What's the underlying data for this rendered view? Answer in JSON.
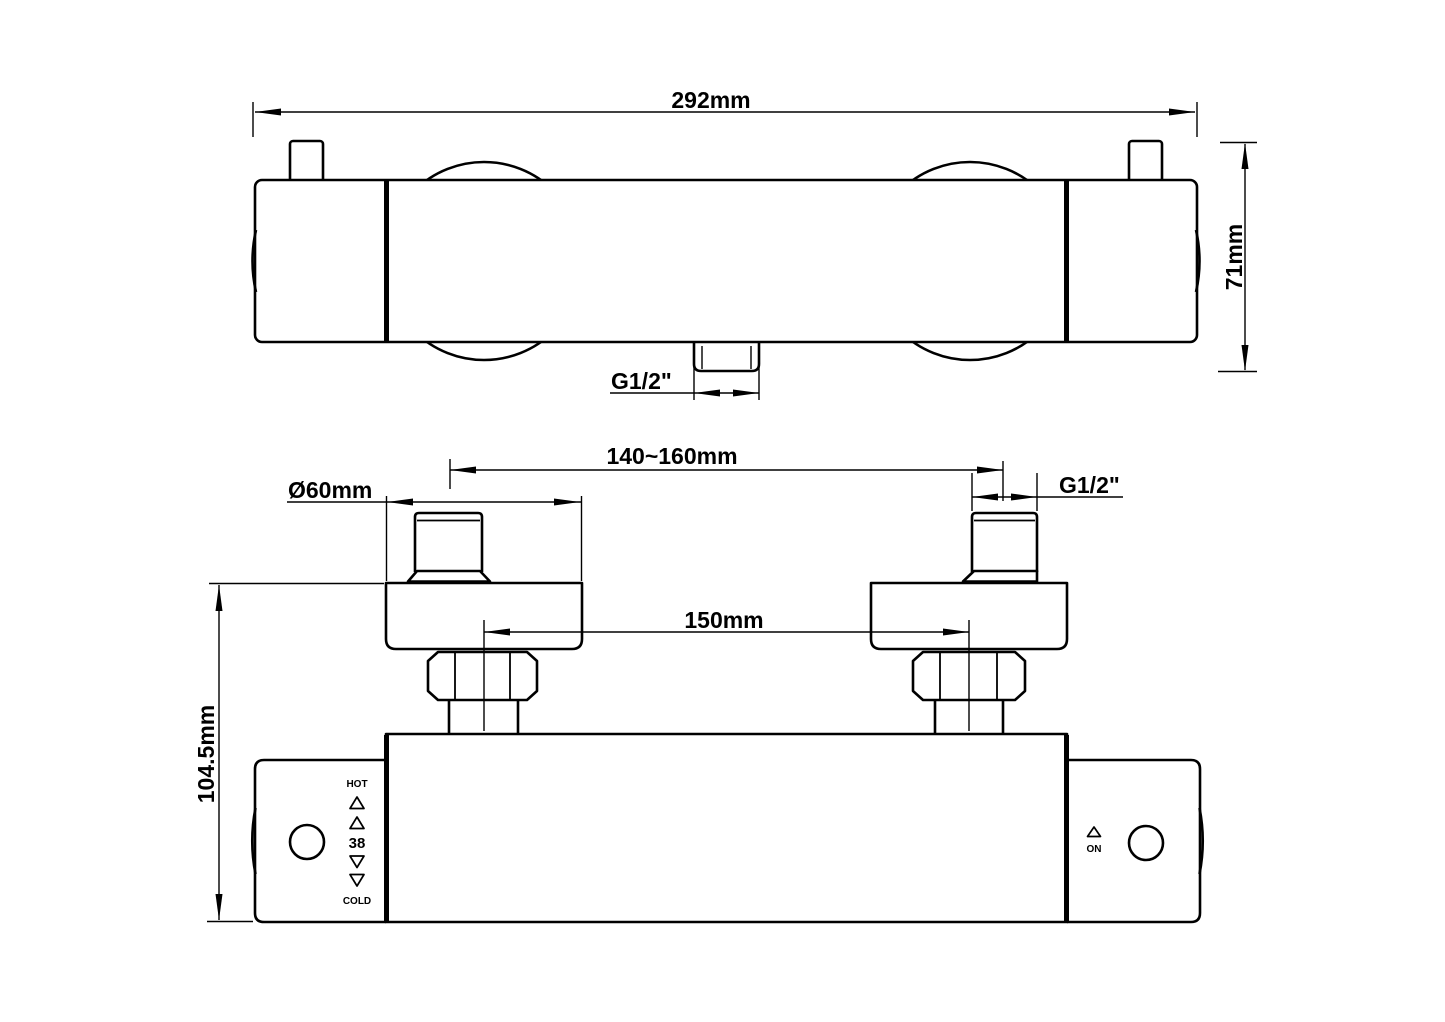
{
  "drawing": {
    "title": "thermostatic-shower-mixer-dimension-drawing",
    "background": "#ffffff",
    "line_color": "#000000",
    "top_view": {
      "width_label": "292mm",
      "height_label": "71mm",
      "outlet_thread_label": "G1/2\""
    },
    "front_view": {
      "pipe_spacing_label": "140~160mm",
      "flange_diameter_label": "Ø60mm",
      "inlet_thread_label": "G1/2\"",
      "inlet_spacing_label": "150mm",
      "height_label": "104.5mm",
      "hot_label": "HOT",
      "cold_label": "COLD",
      "temp_setting_label": "38",
      "on_label": "ON"
    }
  }
}
